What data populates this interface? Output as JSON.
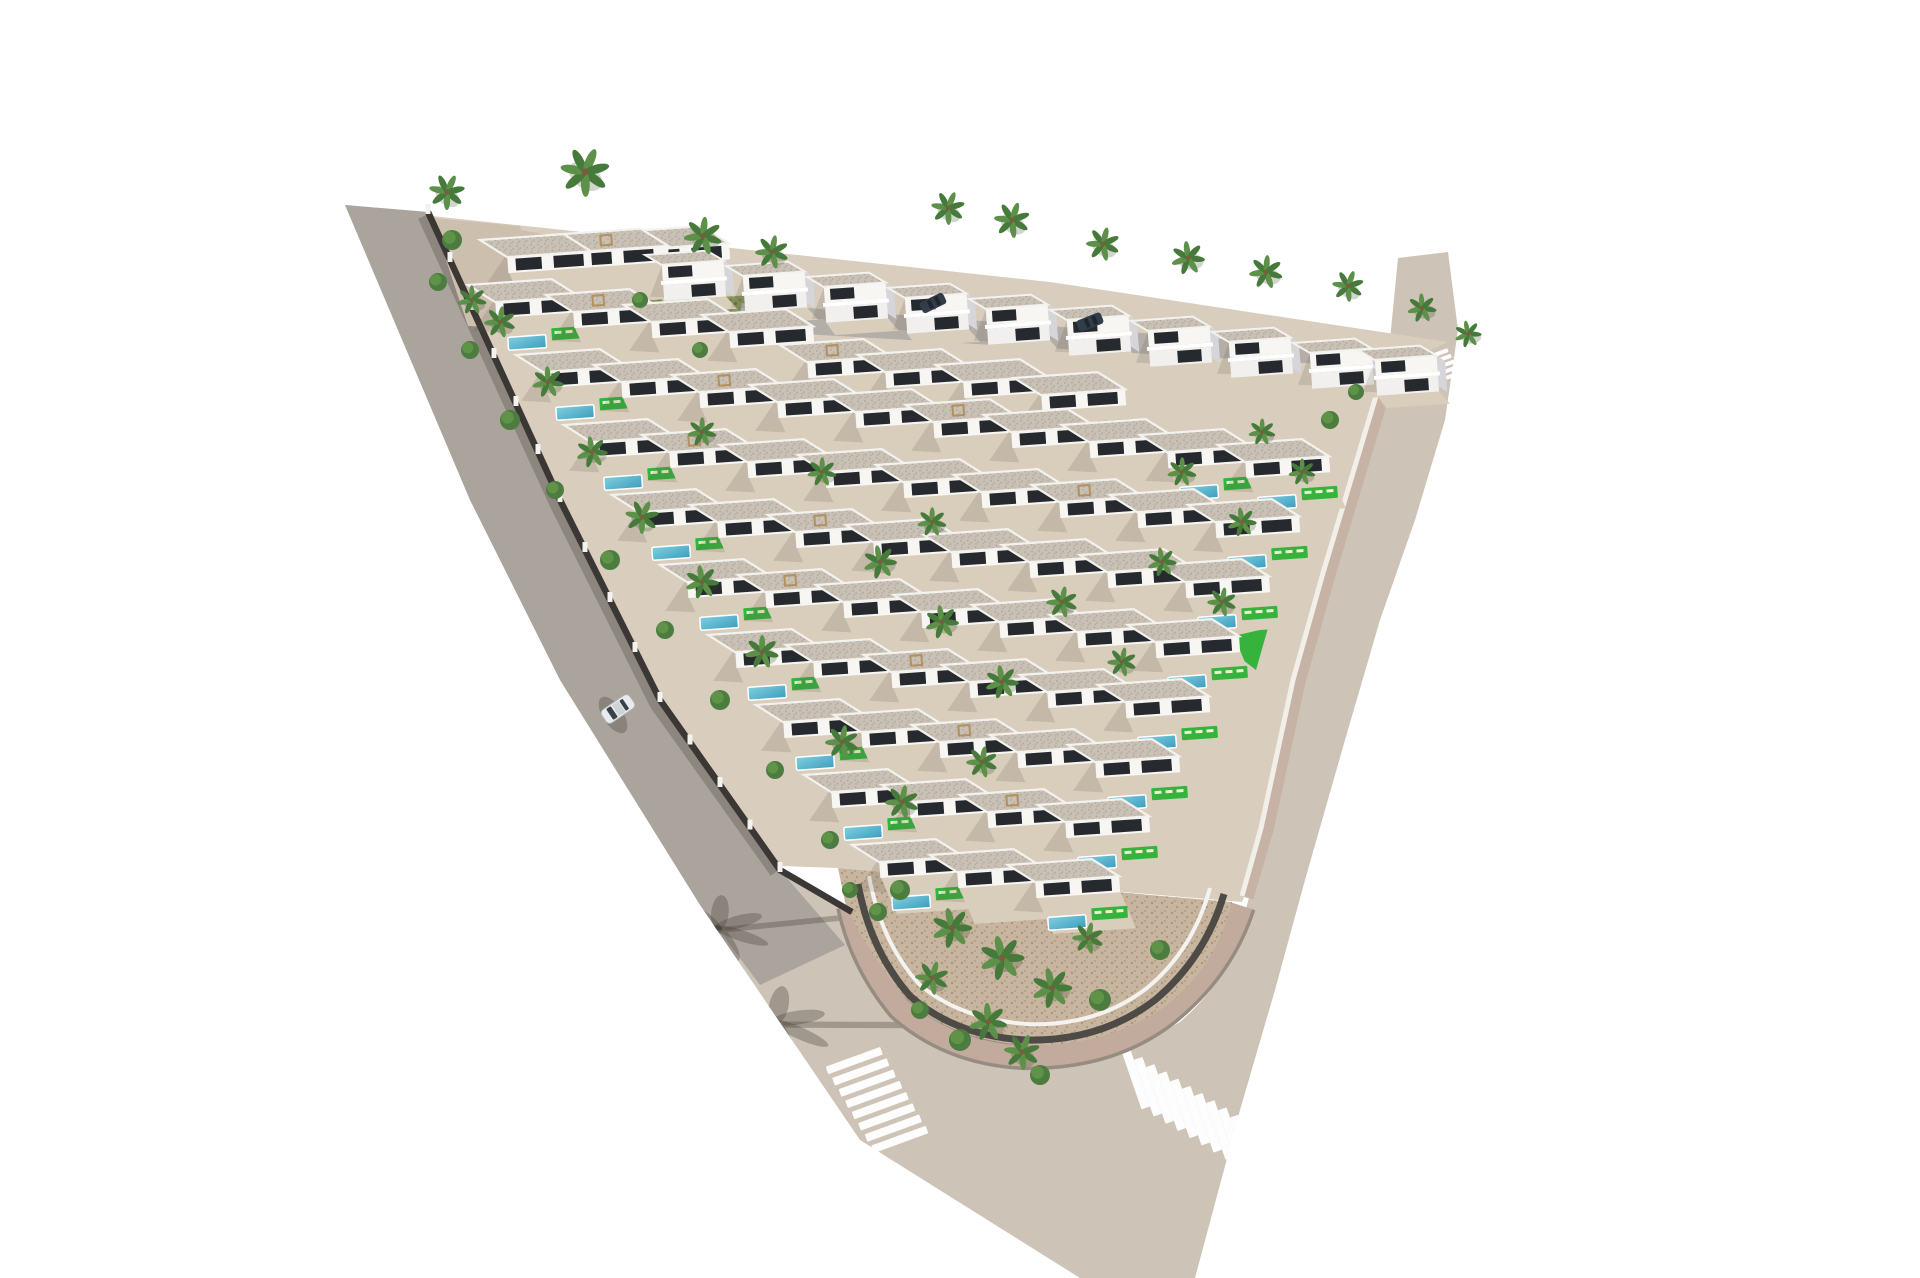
{
  "scene": {
    "type": "aerial-3d-architectural-render",
    "subject": "triangular-villa-development-with-pools",
    "canvas": {
      "width": 1920,
      "height": 1278,
      "background": "#ffffff"
    },
    "palette": {
      "road_beige": "#cdc3b6",
      "road_tint": "rgba(138,134,131,0.5)",
      "wall_shadow": "rgba(62,56,50,0.28)",
      "crosswalk_white": "#ffffff",
      "curb_under": "#968c82",
      "sidewalk_pink": "#c2aa9d",
      "base_tan": "#d9cdbd",
      "sand": "#c7b5a0",
      "sand_dot": "#ab967e",
      "u_wall": "#4e4a46",
      "garden_wall_white": "#f5f3ef",
      "right_walk": "#c6b3a5",
      "right_wall": "#f2efe9",
      "strip_wall": "#d2c7b1",
      "strip_green": "#8b9763",
      "leaf_dot": "#6f7f49",
      "street_gray": "#b4aea8",
      "tl_patch": "#cdbfae",
      "wall_dark": "#3b3734",
      "pillar": "#f4f2ee",
      "lawn": "#36b33c",
      "pool_light": "#7fd0e0",
      "pool_deep": "#3e9dbd",
      "roof_base": "#c9c1b5",
      "roof_dot": "#afa698",
      "parapet": "#f4f2ee",
      "villa_white": "#f7f6f3",
      "terrace": "#d9cdbc",
      "window_dark": "#262a2e",
      "villa_shadow": "rgba(85,78,70,0.16)",
      "duplex_side": "#d6d6da",
      "palm1": "#5d9048",
      "palm2": "#467a3a",
      "trunk": "#7a5c3e",
      "bush1": "#4c7c40",
      "bush2": "#5f9448",
      "lounger": "#eef2d2",
      "car_body": "#e9ebee",
      "car_glass": "#3a4148",
      "car_roof": "#cfd3d6",
      "car_stroke": "#aeb2b6",
      "parked_car": "#313d49",
      "parked_glass": "#20262c",
      "road_shadow": "rgba(70,64,58,0.33)",
      "pergola": "#b2905f"
    },
    "road_path": "M345,205 L470,500 L560,680 L700,905 L860,1140 L1080,1278 L1195,1278 L1240,1110 L1275,990 L1305,880 L1345,740 L1380,620 L1415,520 L1445,420 L1458,330 L1448,252 L1398,258 L1390,340 L1360,480 L1325,590 L1300,680 L1282,760 L1262,850 L1247,905 Q1235,975 1180,1022 Q1105,1065 1020,1062 Q935,1052 888,995 Q862,952 852,915 L780,870 L660,700 L560,500 L428,212 Z",
    "layers": {
      "under": [
        {
          "n": "road-surface",
          "d": "M345,205 L470,500 L560,680 L700,905 L860,1140 L1080,1278 L1195,1278 L1240,1110 L1275,990 L1305,880 L1345,740 L1380,620 L1415,520 L1445,420 L1458,330 L1448,252 L1398,258 L1390,340 L1360,480 L1325,590 L1300,680 L1282,760 L1262,850 L1247,905 Q1235,975 1180,1022 Q1105,1065 1020,1062 Q935,1052 888,995 Q862,952 852,915 L780,870 L660,700 L560,500 L428,212 Z",
          "f": "road_beige"
        },
        {
          "n": "left-road-tint",
          "d": "M345,205 L470,500 L560,680 L700,905 L760,985 L845,945 L780,870 L660,700 L560,500 L428,212 Z",
          "f": "road_tint"
        },
        {
          "n": "wall-shadow-on-road",
          "d": "M424,216 L556,504 L656,704 L776,872",
          "s": "wall_shadow",
          "w": 13
        }
      ],
      "mid": [
        {
          "n": "tip-sidewalk-curb",
          "d": "M850,906 Q862,962 900,1008 Q950,1052 1022,1056 Q1110,1058 1168,1012 Q1222,968 1242,906",
          "s": "curb_under",
          "w": 28
        },
        {
          "n": "tip-sidewalk-pavers",
          "d": "M850,906 Q862,962 900,1008 Q950,1052 1022,1056 Q1110,1058 1168,1012 Q1222,968 1242,906",
          "s": "sidewalk_pink",
          "w": 21
        },
        {
          "n": "plot-base",
          "d": "M432,216 L1050,282 L1448,342 L1392,368 L1330,572 L1298,688 L1262,852 L1242,902 L838,868 L780,866 L660,698 L558,498 L426,210 Z",
          "f": "base_tan"
        },
        {
          "n": "tip-garden",
          "d": "M838,868 L1232,902 Q1216,970 1160,1010 Q1100,1048 1025,1045 Q950,1040 906,998 Q869,955 846,906 Z",
          "f": "url(#sand)"
        },
        {
          "n": "tip-garden-dark-wall",
          "d": "M858,884 Q870,950 910,996 Q955,1036 1025,1040 Q1100,1042 1155,1000 Q1205,958 1224,894",
          "s": "u_wall",
          "w": 7
        },
        {
          "n": "tip-garden-white-wall",
          "d": "M869,876 Q881,942 919,984 Q959,1019 1027,1024 Q1096,1027 1147,988 Q1193,950 1210,888",
          "s": "garden_wall_white",
          "w": 4
        },
        {
          "n": "right-sidewalk",
          "d": "M1392,368 L1330,575 L1300,682 L1268,830 L1248,898",
          "s": "right_walk",
          "w": 11
        },
        {
          "n": "right-boundary-wall",
          "d": "M1385,366 L1323,573 L1293,680 L1261,828 L1242,896",
          "s": "right_wall",
          "w": 5
        },
        {
          "n": "garden-strip-wall",
          "d": "M590,243 L768,292 L762,302 L585,253 Z",
          "f": "strip_wall"
        },
        {
          "n": "garden-strip",
          "d": "M598,252 L762,298 L744,332 L580,287 Z",
          "f": "strip_green"
        },
        {
          "n": "garden-strip-foliage",
          "d": "M598,252 L762,298 L744,332 L580,287 Z",
          "f": "url(#leaves)",
          "o": 0.85
        },
        {
          "n": "topleft-wall-band",
          "d": "M498,226 L600,244 L598,253 L496,235 Z",
          "f": "tl_patch"
        },
        {
          "n": "internal-street",
          "d": "M742,303 L1396,352 L1390,368 L736,330 Z",
          "f": "street_gray"
        },
        {
          "n": "topleft-garden-patch",
          "d": "M432,218 L520,226 L560,330 L468,326 Z",
          "f": "tl_patch"
        },
        {
          "n": "perimeter-wall-dark",
          "d": "M428,212 L560,500 L660,700 L780,870 L852,912",
          "s": "wall_dark",
          "w": 6.5
        },
        {
          "n": "triangle-lawn",
          "d": "M1217,640 L1268,628 L1256,670 Z",
          "f": "lawn"
        },
        {
          "n": "lawn-pool",
          "d": "M1185,664 L1225,660 L1228,674 L1188,678 Z",
          "f": "url(#pool)",
          "s2": "#ffffff",
          "w": 1.2
        }
      ]
    },
    "crosswalks": [
      {
        "n": "crosswalk-left",
        "cx": 877,
        "cy": 1100,
        "axis": 60,
        "stripe": -20,
        "count": 8,
        "len": 58,
        "w": 8,
        "step": 13
      },
      {
        "n": "crosswalk-right",
        "cx": 1190,
        "cy": 1112,
        "axis": 31,
        "stripe": 71,
        "count": 10,
        "len": 60,
        "w": 9,
        "step": 14
      },
      {
        "n": "crosswalk-mini",
        "cx": 1447,
        "cy": 364,
        "axis": 60,
        "stripe": -20,
        "count": 5,
        "len": 16,
        "w": 4,
        "step": 6.5
      }
    ],
    "palm_shadows": [
      {
        "x": 718,
        "y": 928,
        "rot": 12,
        "s": 1.9
      },
      {
        "x": 775,
        "y": 1022,
        "rot": 18,
        "s": 2.1
      }
    ],
    "wall_pillars": {
      "polyline": [
        [
          428,
          212
        ],
        [
          560,
          500
        ],
        [
          660,
          700
        ],
        [
          780,
          870
        ]
      ],
      "spacing": 46
    },
    "villas_single": [
      [
        480,
        240,
        0,
        0
      ],
      [
        550,
        235,
        0,
        1
      ],
      [
        618,
        232,
        0,
        0
      ],
      [
        468,
        285,
        1,
        0
      ],
      [
        546,
        295,
        0,
        1
      ],
      [
        624,
        305,
        0,
        0
      ],
      [
        702,
        315,
        0,
        0
      ],
      [
        780,
        345,
        0,
        1
      ],
      [
        858,
        355,
        0,
        0
      ],
      [
        936,
        365,
        0,
        0
      ],
      [
        1014,
        378,
        1,
        0
      ],
      [
        516,
        355,
        1,
        0
      ],
      [
        594,
        365,
        0,
        0
      ],
      [
        672,
        375,
        0,
        1
      ],
      [
        750,
        385,
        0,
        0
      ],
      [
        828,
        395,
        0,
        0
      ],
      [
        906,
        405,
        0,
        1
      ],
      [
        984,
        415,
        0,
        0
      ],
      [
        1062,
        425,
        0,
        0
      ],
      [
        1140,
        435,
        1,
        0
      ],
      [
        1218,
        445,
        1,
        0
      ],
      [
        564,
        425,
        1,
        0
      ],
      [
        642,
        435,
        0,
        1
      ],
      [
        720,
        445,
        0,
        0
      ],
      [
        798,
        455,
        0,
        0
      ],
      [
        876,
        465,
        0,
        0
      ],
      [
        954,
        475,
        0,
        0
      ],
      [
        1032,
        485,
        0,
        1
      ],
      [
        1110,
        495,
        0,
        0
      ],
      [
        1188,
        505,
        1,
        0
      ],
      [
        612,
        495,
        1,
        0
      ],
      [
        690,
        505,
        0,
        0
      ],
      [
        768,
        515,
        0,
        1
      ],
      [
        846,
        525,
        0,
        0
      ],
      [
        924,
        535,
        0,
        0
      ],
      [
        1002,
        545,
        0,
        0
      ],
      [
        1080,
        555,
        0,
        0
      ],
      [
        1158,
        565,
        1,
        0
      ],
      [
        660,
        565,
        1,
        0
      ],
      [
        738,
        575,
        0,
        1
      ],
      [
        816,
        585,
        0,
        0
      ],
      [
        894,
        595,
        0,
        0
      ],
      [
        972,
        605,
        0,
        0
      ],
      [
        1050,
        615,
        0,
        0
      ],
      [
        1128,
        625,
        1,
        0
      ],
      [
        708,
        635,
        1,
        0
      ],
      [
        786,
        645,
        0,
        0
      ],
      [
        864,
        655,
        0,
        1
      ],
      [
        942,
        665,
        0,
        0
      ],
      [
        1020,
        675,
        0,
        0
      ],
      [
        1098,
        685,
        1,
        0
      ],
      [
        756,
        705,
        1,
        0
      ],
      [
        834,
        715,
        0,
        0
      ],
      [
        912,
        725,
        0,
        1
      ],
      [
        990,
        735,
        0,
        0
      ],
      [
        1068,
        745,
        1,
        0
      ],
      [
        804,
        775,
        1,
        0
      ],
      [
        882,
        785,
        0,
        0
      ],
      [
        960,
        795,
        0,
        1
      ],
      [
        1038,
        805,
        1,
        0
      ],
      [
        852,
        845,
        1,
        0
      ],
      [
        930,
        855,
        0,
        0
      ],
      [
        1008,
        865,
        1,
        0
      ]
    ],
    "villas_duplex": [
      [
        645,
        255
      ],
      [
        726,
        266
      ],
      [
        807,
        277
      ],
      [
        888,
        288
      ],
      [
        969,
        299
      ],
      [
        1050,
        310
      ],
      [
        1131,
        321
      ],
      [
        1212,
        332
      ],
      [
        1293,
        343
      ],
      [
        1358,
        350
      ]
    ],
    "palms": [
      [
        585,
        172,
        22
      ],
      [
        447,
        192,
        16
      ],
      [
        703,
        236,
        17
      ],
      [
        772,
        252,
        15
      ],
      [
        948,
        208,
        15
      ],
      [
        1012,
        220,
        16
      ],
      [
        1103,
        244,
        15
      ],
      [
        1188,
        258,
        15
      ],
      [
        1266,
        272,
        15
      ],
      [
        1348,
        286,
        14
      ],
      [
        472,
        300,
        13
      ],
      [
        500,
        322,
        14
      ],
      [
        548,
        382,
        14
      ],
      [
        592,
        452,
        14
      ],
      [
        642,
        517,
        15
      ],
      [
        702,
        582,
        15
      ],
      [
        762,
        652,
        15
      ],
      [
        822,
        472,
        13
      ],
      [
        702,
        432,
        13
      ],
      [
        880,
        562,
        15
      ],
      [
        942,
        622,
        15
      ],
      [
        1002,
        682,
        15
      ],
      [
        932,
        522,
        13
      ],
      [
        1062,
        602,
        14
      ],
      [
        842,
        742,
        15
      ],
      [
        902,
        802,
        15
      ],
      [
        982,
        762,
        14
      ],
      [
        1182,
        472,
        13
      ],
      [
        1242,
        522,
        13
      ],
      [
        1302,
        472,
        12
      ],
      [
        1162,
        562,
        13
      ],
      [
        1222,
        602,
        13
      ],
      [
        1122,
        662,
        13
      ],
      [
        1262,
        432,
        12
      ],
      [
        1422,
        308,
        13
      ],
      [
        1468,
        334,
        12
      ],
      [
        952,
        928,
        18
      ],
      [
        1002,
        958,
        20
      ],
      [
        1052,
        988,
        18
      ],
      [
        988,
        1022,
        17
      ],
      [
        932,
        978,
        15
      ],
      [
        1088,
        938,
        14
      ],
      [
        1022,
        1052,
        16
      ]
    ],
    "bushes": [
      [
        452,
        240,
        10
      ],
      [
        438,
        282,
        9
      ],
      [
        470,
        350,
        9
      ],
      [
        510,
        420,
        10
      ],
      [
        555,
        490,
        9
      ],
      [
        610,
        560,
        10
      ],
      [
        665,
        630,
        9
      ],
      [
        720,
        700,
        10
      ],
      [
        775,
        770,
        9
      ],
      [
        830,
        840,
        9
      ],
      [
        900,
        890,
        10
      ],
      [
        960,
        1040,
        11
      ],
      [
        1100,
        1000,
        11
      ],
      [
        1160,
        950,
        10
      ],
      [
        640,
        300,
        8
      ],
      [
        700,
        350,
        8
      ],
      [
        1330,
        420,
        9
      ],
      [
        1356,
        392,
        8
      ],
      [
        878,
        912,
        9
      ],
      [
        850,
        890,
        8
      ],
      [
        1040,
        1075,
        10
      ],
      [
        920,
        1010,
        9
      ]
    ],
    "car": {
      "x": 618,
      "y": 709,
      "angle": 236
    },
    "parked_cars": [
      {
        "x": 933,
        "y": 303,
        "angle": 64
      },
      {
        "x": 1090,
        "y": 322,
        "angle": 68
      }
    ]
  }
}
